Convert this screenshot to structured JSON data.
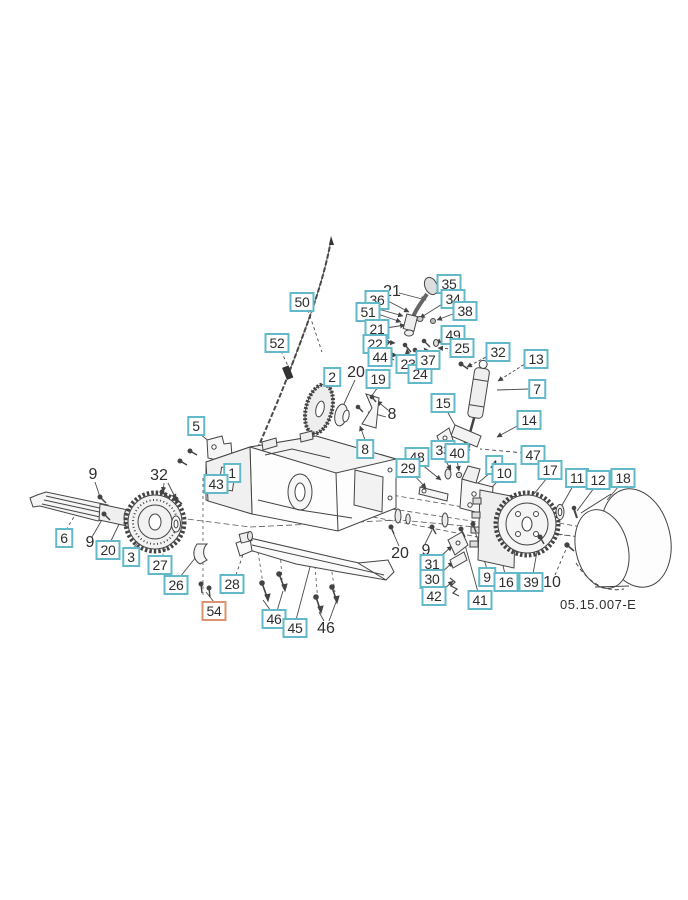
{
  "page": {
    "type": "exploded-parts-diagram",
    "code_label": "05.15.007-E"
  },
  "colors": {
    "callout_border_teal": "#63b9c9",
    "callout_border_orange": "#d9936f",
    "line_art": "#444444",
    "text": "#2d2d2d",
    "background": "#ffffff"
  },
  "callouts": [
    {
      "text": "50",
      "x": 302,
      "y": 302,
      "style": "boxed",
      "accent": "teal"
    },
    {
      "text": "52",
      "x": 277,
      "y": 343,
      "style": "boxed",
      "accent": "teal"
    },
    {
      "text": "21",
      "x": 392,
      "y": 292,
      "style": "plain",
      "accent": "none"
    },
    {
      "text": "36",
      "x": 377,
      "y": 300,
      "style": "boxed",
      "accent": "teal"
    },
    {
      "text": "51",
      "x": 368,
      "y": 312,
      "style": "boxed",
      "accent": "teal"
    },
    {
      "text": "21",
      "x": 377,
      "y": 329,
      "style": "boxed",
      "accent": "teal"
    },
    {
      "text": "22",
      "x": 375,
      "y": 344,
      "style": "boxed",
      "accent": "teal"
    },
    {
      "text": "44",
      "x": 380,
      "y": 357,
      "style": "boxed",
      "accent": "teal"
    },
    {
      "text": "23",
      "x": 408,
      "y": 364,
      "style": "boxed",
      "accent": "teal"
    },
    {
      "text": "24",
      "x": 420,
      "y": 374,
      "style": "boxed",
      "accent": "teal"
    },
    {
      "text": "37",
      "x": 428,
      "y": 360,
      "style": "boxed",
      "accent": "teal"
    },
    {
      "text": "49",
      "x": 453,
      "y": 335,
      "style": "boxed",
      "accent": "teal"
    },
    {
      "text": "25",
      "x": 462,
      "y": 348,
      "style": "boxed",
      "accent": "teal"
    },
    {
      "text": "35",
      "x": 449,
      "y": 284,
      "style": "boxed",
      "accent": "teal"
    },
    {
      "text": "34",
      "x": 453,
      "y": 299,
      "style": "boxed",
      "accent": "teal"
    },
    {
      "text": "38",
      "x": 465,
      "y": 311,
      "style": "boxed",
      "accent": "teal"
    },
    {
      "text": "2",
      "x": 332,
      "y": 377,
      "style": "boxed",
      "accent": "teal"
    },
    {
      "text": "20",
      "x": 356,
      "y": 373,
      "style": "plain",
      "accent": "none"
    },
    {
      "text": "19",
      "x": 378,
      "y": 379,
      "style": "boxed",
      "accent": "teal"
    },
    {
      "text": "8",
      "x": 392,
      "y": 415,
      "style": "plain",
      "accent": "none"
    },
    {
      "text": "32",
      "x": 498,
      "y": 352,
      "style": "boxed",
      "accent": "teal"
    },
    {
      "text": "13",
      "x": 536,
      "y": 359,
      "style": "boxed",
      "accent": "teal"
    },
    {
      "text": "7",
      "x": 537,
      "y": 389,
      "style": "boxed",
      "accent": "teal"
    },
    {
      "text": "15",
      "x": 443,
      "y": 403,
      "style": "boxed",
      "accent": "teal"
    },
    {
      "text": "14",
      "x": 529,
      "y": 420,
      "style": "boxed",
      "accent": "teal"
    },
    {
      "text": "47",
      "x": 533,
      "y": 455,
      "style": "boxed",
      "accent": "teal"
    },
    {
      "text": "5",
      "x": 196,
      "y": 426,
      "style": "boxed",
      "accent": "teal"
    },
    {
      "text": "1",
      "x": 232,
      "y": 473,
      "style": "boxed",
      "accent": "teal"
    },
    {
      "text": "43",
      "x": 216,
      "y": 484,
      "style": "boxed",
      "accent": "teal"
    },
    {
      "text": "8",
      "x": 365,
      "y": 449,
      "style": "boxed",
      "accent": "teal"
    },
    {
      "text": "48",
      "x": 417,
      "y": 457,
      "style": "boxed",
      "accent": "teal"
    },
    {
      "text": "29",
      "x": 408,
      "y": 468,
      "style": "boxed",
      "accent": "teal"
    },
    {
      "text": "33",
      "x": 443,
      "y": 450,
      "style": "boxed",
      "accent": "teal"
    },
    {
      "text": "40",
      "x": 457,
      "y": 453,
      "style": "boxed",
      "accent": "teal"
    },
    {
      "text": "4",
      "x": 494,
      "y": 465,
      "style": "boxed",
      "accent": "teal"
    },
    {
      "text": "10",
      "x": 504,
      "y": 473,
      "style": "boxed",
      "accent": "teal"
    },
    {
      "text": "17",
      "x": 550,
      "y": 470,
      "style": "boxed",
      "accent": "teal"
    },
    {
      "text": "11",
      "x": 577,
      "y": 478,
      "style": "boxed",
      "accent": "teal"
    },
    {
      "text": "12",
      "x": 598,
      "y": 480,
      "style": "boxed",
      "accent": "teal"
    },
    {
      "text": "18",
      "x": 623,
      "y": 478,
      "style": "boxed",
      "accent": "teal"
    },
    {
      "text": "9",
      "x": 93,
      "y": 475,
      "style": "plain",
      "accent": "none"
    },
    {
      "text": "32",
      "x": 159,
      "y": 476,
      "style": "plain",
      "accent": "none"
    },
    {
      "text": "6",
      "x": 64,
      "y": 538,
      "style": "boxed",
      "accent": "teal"
    },
    {
      "text": "9",
      "x": 90,
      "y": 543,
      "style": "plain",
      "accent": "none"
    },
    {
      "text": "20",
      "x": 108,
      "y": 550,
      "style": "boxed",
      "accent": "teal"
    },
    {
      "text": "3",
      "x": 131,
      "y": 557,
      "style": "boxed",
      "accent": "teal"
    },
    {
      "text": "27",
      "x": 160,
      "y": 565,
      "style": "boxed",
      "accent": "teal"
    },
    {
      "text": "26",
      "x": 176,
      "y": 585,
      "style": "boxed",
      "accent": "teal"
    },
    {
      "text": "54",
      "x": 214,
      "y": 611,
      "style": "boxed",
      "accent": "orange"
    },
    {
      "text": "28",
      "x": 232,
      "y": 584,
      "style": "boxed",
      "accent": "teal"
    },
    {
      "text": "20",
      "x": 400,
      "y": 554,
      "style": "plain",
      "accent": "none"
    },
    {
      "text": "9",
      "x": 426,
      "y": 551,
      "style": "plain",
      "accent": "none"
    },
    {
      "text": "31",
      "x": 432,
      "y": 564,
      "style": "boxed",
      "accent": "teal"
    },
    {
      "text": "30",
      "x": 432,
      "y": 579,
      "style": "boxed",
      "accent": "teal"
    },
    {
      "text": "42",
      "x": 434,
      "y": 596,
      "style": "boxed",
      "accent": "teal"
    },
    {
      "text": "41",
      "x": 480,
      "y": 600,
      "style": "boxed",
      "accent": "teal"
    },
    {
      "text": "9",
      "x": 487,
      "y": 577,
      "style": "boxed",
      "accent": "teal"
    },
    {
      "text": "16",
      "x": 506,
      "y": 582,
      "style": "boxed",
      "accent": "teal"
    },
    {
      "text": "39",
      "x": 531,
      "y": 582,
      "style": "boxed",
      "accent": "teal"
    },
    {
      "text": "10",
      "x": 552,
      "y": 583,
      "style": "plain",
      "accent": "none"
    },
    {
      "text": "46",
      "x": 274,
      "y": 619,
      "style": "boxed",
      "accent": "teal"
    },
    {
      "text": "45",
      "x": 295,
      "y": 628,
      "style": "boxed",
      "accent": "teal"
    },
    {
      "text": "46",
      "x": 326,
      "y": 629,
      "style": "plain",
      "accent": "none"
    }
  ]
}
